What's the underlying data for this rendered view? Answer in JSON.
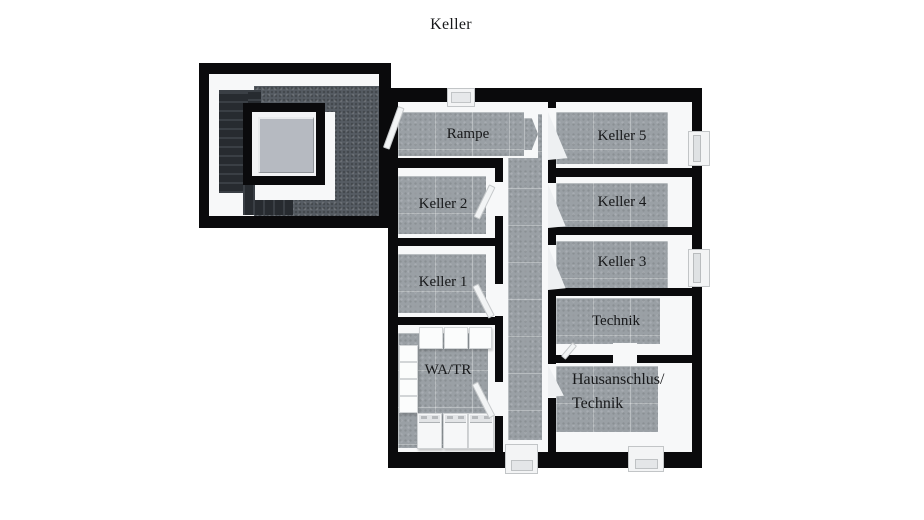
{
  "title": "Keller",
  "rooms": {
    "rampe": {
      "label": "Rampe"
    },
    "keller5": {
      "label": "Keller 5"
    },
    "keller2": {
      "label": "Keller 2"
    },
    "keller4": {
      "label": "Keller 4"
    },
    "keller1": {
      "label": "Keller 1"
    },
    "keller3": {
      "label": "Keller 3"
    },
    "technik": {
      "label": "Technik"
    },
    "watr": {
      "label": "WA/TR"
    },
    "hausanschluss": {
      "line1": "Hausanschlus/",
      "line2": "Technik"
    }
  },
  "colors": {
    "wall": "#0a0a0c",
    "floor": "#9aa0a5",
    "stairwell_floor": "#565c63",
    "elevator_core": "#b6bac1",
    "label_text": "#17181a"
  },
  "equipment": {
    "watr": {
      "top_row_units": 3,
      "side_column_units": 4,
      "washer_row_units": 3
    },
    "windows": 2,
    "bottom_exits": 2
  }
}
